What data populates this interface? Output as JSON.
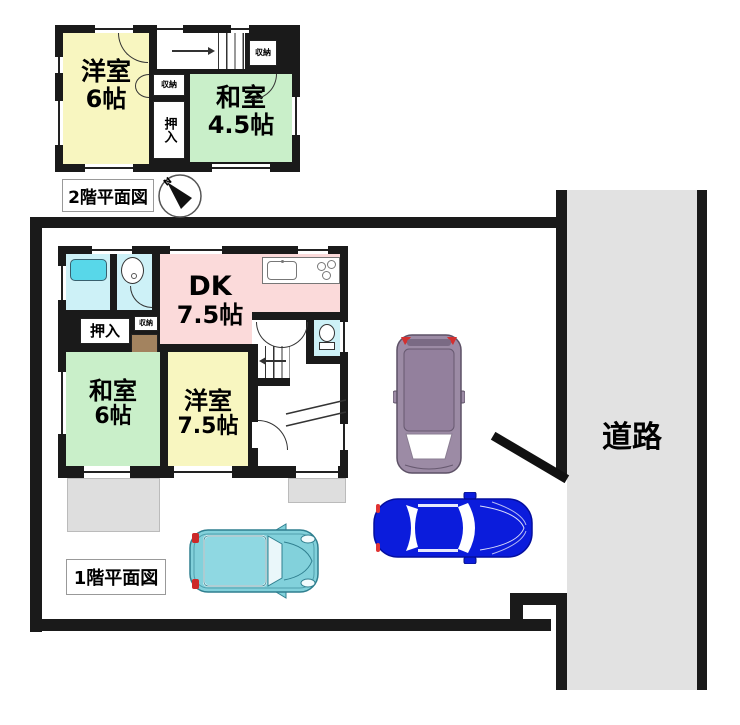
{
  "colors": {
    "wall_black": "#1a1a1a",
    "room_yellow": "#f8f6c0",
    "room_green": "#c9efc9",
    "room_pink": "#fbdada",
    "room_cyan": "#cdf1f7",
    "bathtub_cyan": "#58d7e9",
    "road_gray": "#e2e2e2",
    "porch_gray": "#dedede",
    "entry_brown": "#a3835f",
    "car_purple": "#9c8ba5",
    "car_blue": "#0b1cdc",
    "car_teal": "#82d1db",
    "taillight_red": "#d23030"
  },
  "floor2": {
    "label": "2階平面図",
    "compass_n": "N",
    "rooms": {
      "yoshitsu": {
        "name": "洋室",
        "size": "6帖"
      },
      "washitsu": {
        "name": "和室",
        "size": "4.5帖"
      }
    },
    "closet": "押入",
    "storage_top": "収納",
    "storage_mid": "収納"
  },
  "floor1": {
    "label": "1階平面図",
    "rooms": {
      "dk": {
        "name": "DK",
        "size": "7.5帖"
      },
      "washitsu": {
        "name": "和室",
        "size": "6帖"
      },
      "yoshitsu": {
        "name": "洋室",
        "size": "7.5帖"
      }
    },
    "closet": "押入",
    "storage": "収納"
  },
  "road": {
    "label": "道路"
  }
}
